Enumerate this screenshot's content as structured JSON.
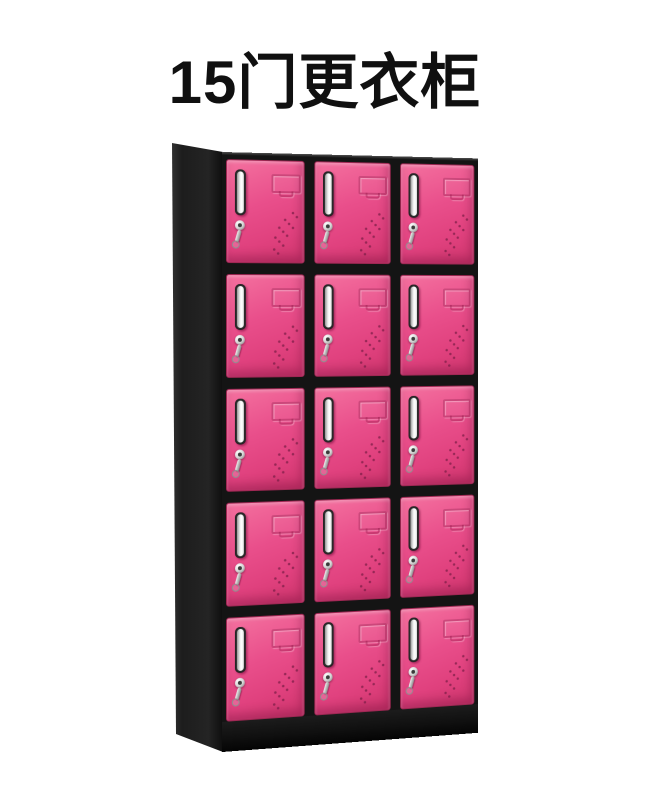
{
  "title": {
    "text": "15门更衣柜"
  },
  "cabinet": {
    "description": "15-door changing locker, black frame with pink doors",
    "rows": 5,
    "columns": 3,
    "door_count": 15,
    "colors": {
      "background": "#ffffff",
      "title_text": "#101010",
      "door_pink": "#e94f8b",
      "door_pink_light": "#f4719f",
      "door_pink_dark": "#cf356d",
      "door_border": "#9f2753",
      "frame_black": "#141414",
      "side_panel_gray": "#242424",
      "handle_silver": "#f0f0f0",
      "lock_chrome": "#d6d6d6",
      "vent_dot": "#7e1f48"
    }
  }
}
